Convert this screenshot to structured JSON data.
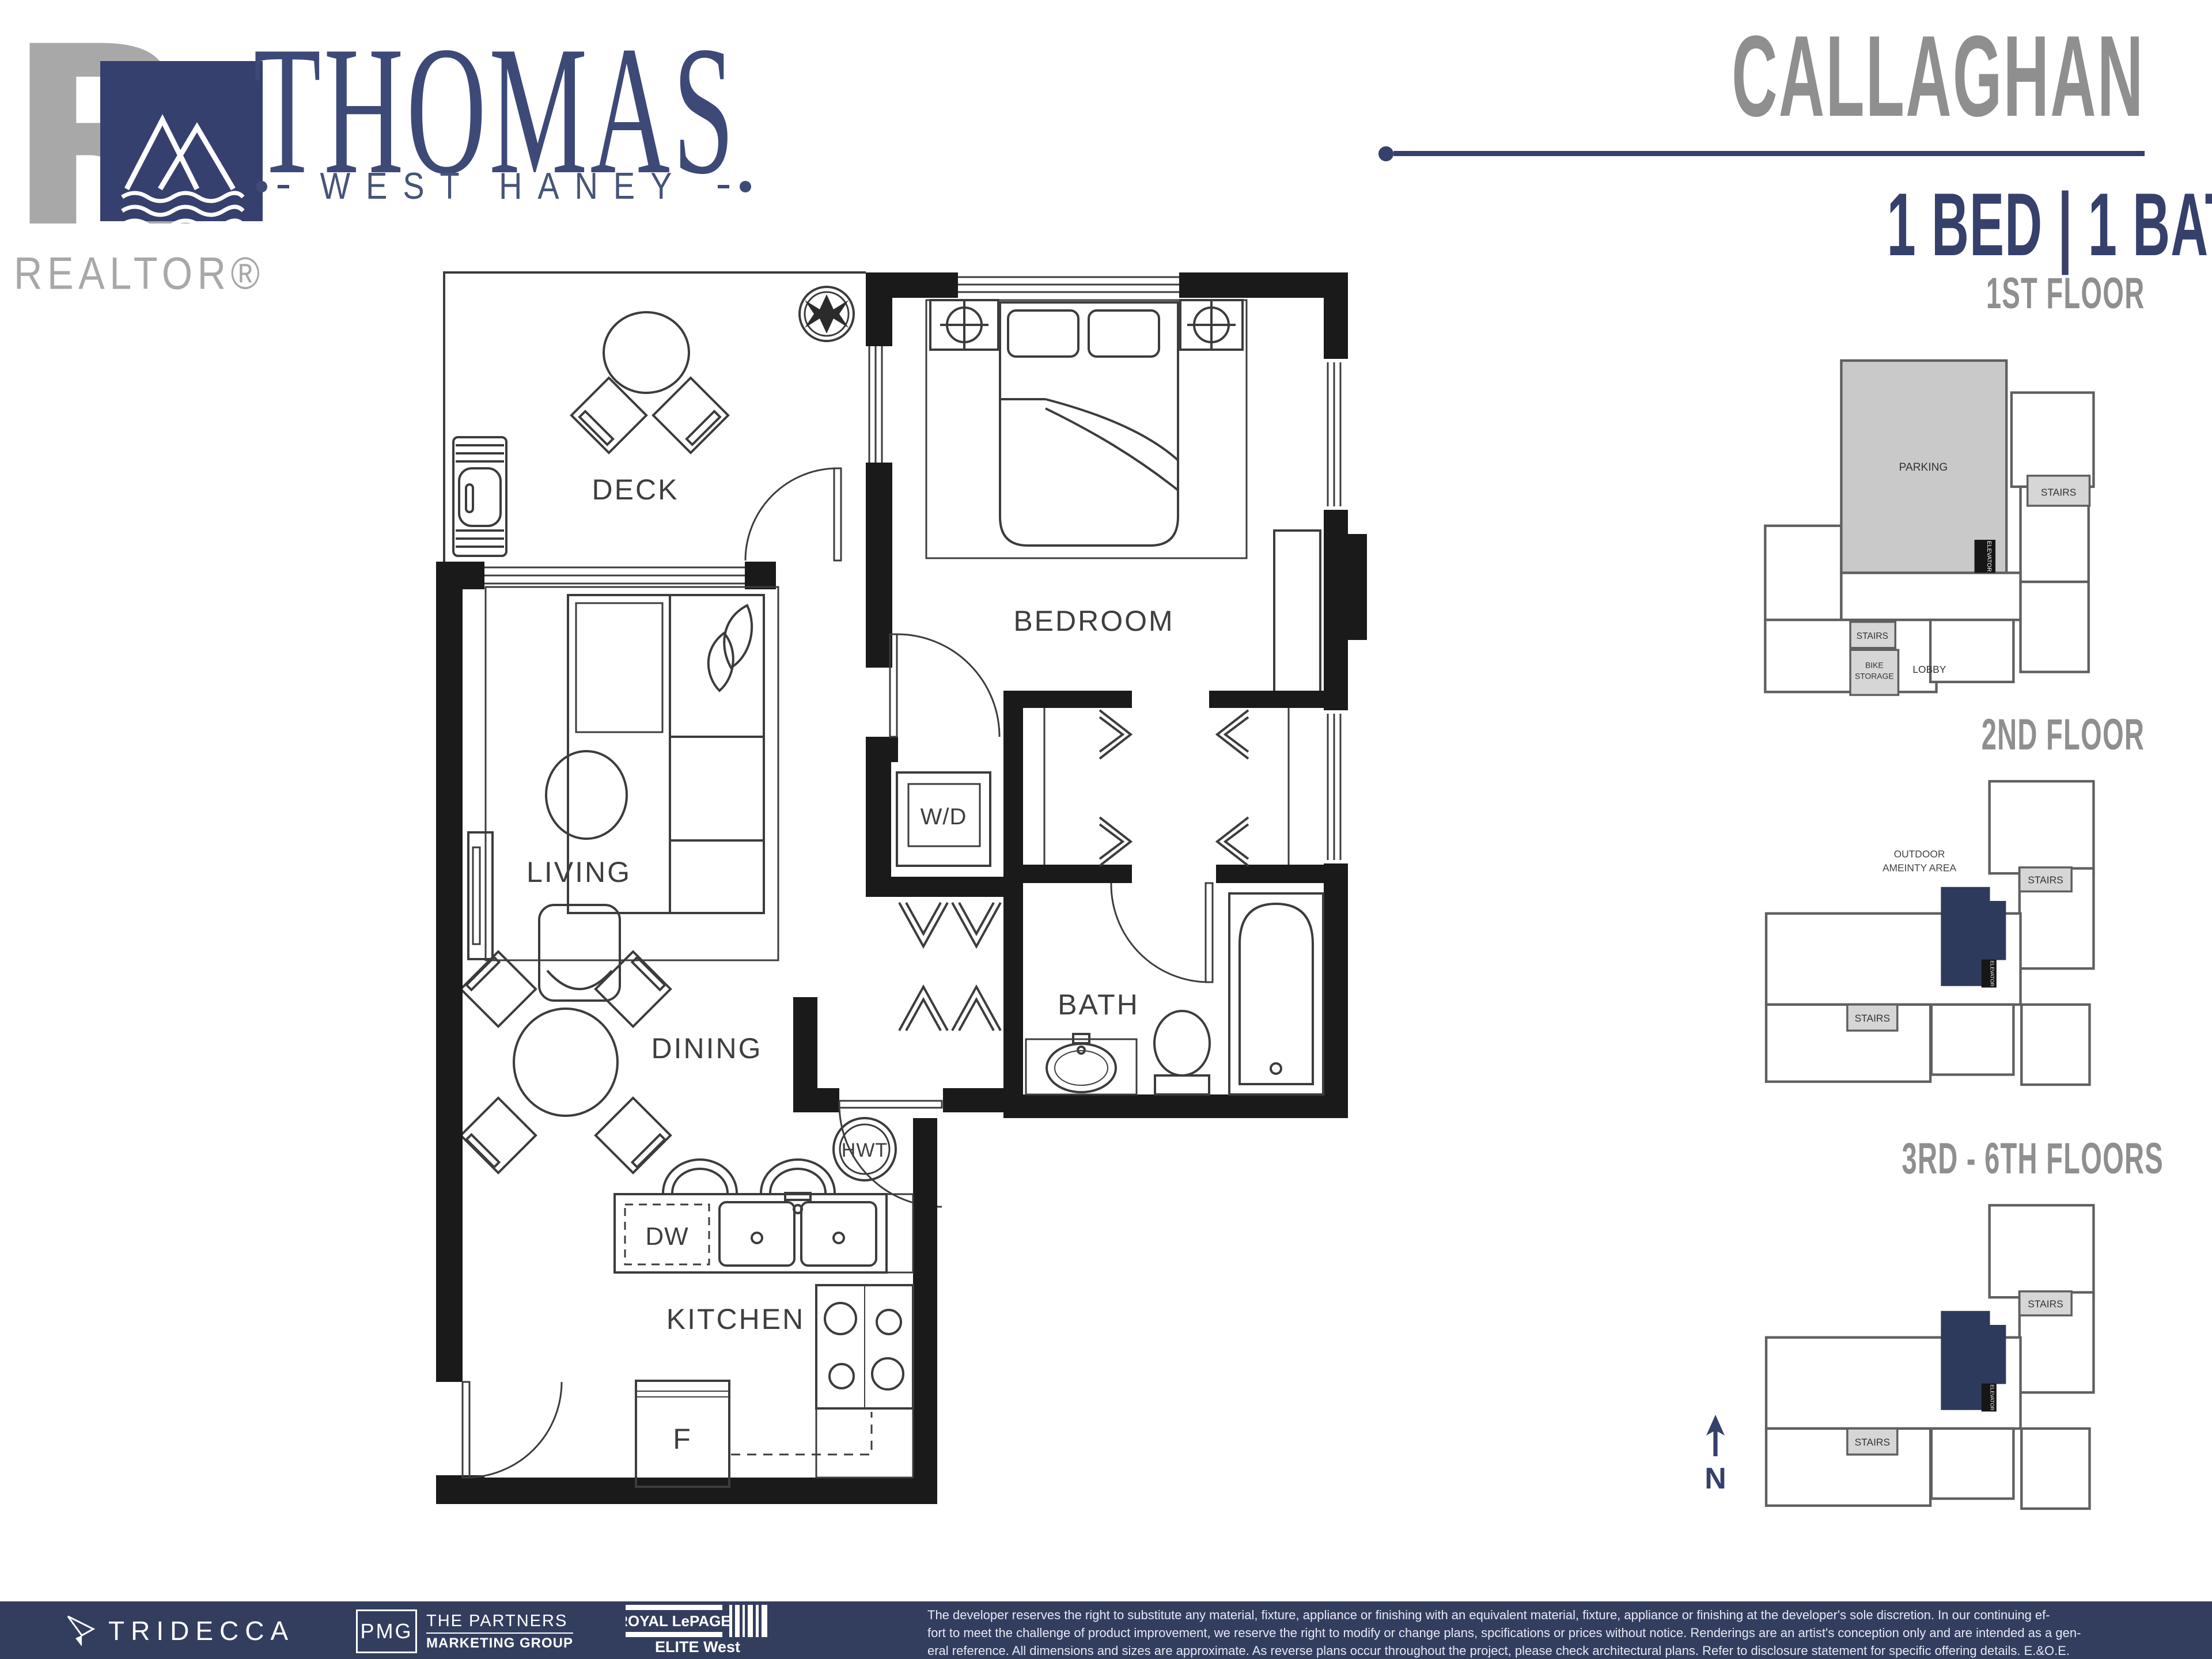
{
  "header": {
    "brand": {
      "realtor_label": "REALTOR®",
      "title": "THOMAS",
      "subtitle": "WEST HANEY"
    },
    "unit": {
      "name": "CALLAGHAN",
      "specs": "1 BED | 1 BATH | 618 SQ.FT."
    }
  },
  "floorplan": {
    "rooms": {
      "deck": "DECK",
      "bedroom": "BEDROOM",
      "living": "LIVING",
      "dining": "DINING",
      "bath": "BATH",
      "kitchen": "KITCHEN"
    },
    "fixtures": {
      "wd": "W/D",
      "hwt": "HWT",
      "dw": "DW",
      "fridge": "F"
    }
  },
  "keyplans": {
    "first": {
      "title": "1ST FLOOR",
      "parking": "PARKING",
      "stairs_upper": "STAIRS",
      "stairs_lower": "STAIRS",
      "bike_line1": "BIKE",
      "bike_line2": "STORAGE",
      "lobby": "LOBBY",
      "elevator": "ELEVATOR"
    },
    "second": {
      "title": "2ND FLOOR",
      "outdoor_line1": "OUTDOOR",
      "outdoor_line2": "AMEINTY AREA",
      "stairs_upper": "STAIRS",
      "stairs_lower": "STAIRS",
      "elevator": "ELEVATOR"
    },
    "upper": {
      "title": "3RD - 6TH FLOORS",
      "stairs_upper": "STAIRS",
      "stairs_lower": "STAIRS",
      "elevator": "ELEVATOR"
    },
    "north_label": "N"
  },
  "footer": {
    "logos": {
      "tridecca": "TRIDECCA",
      "pmg_abbr": "PMG",
      "pmg_line1": "THE PARTNERS",
      "pmg_line2": "MARKETING GROUP",
      "royal": "ROYAL LePAGE",
      "royal_sub": "ELITE West"
    },
    "disclaimer_lines": [
      "The developer reserves the right to substitute any material, fixture, appliance or finishing with an equivalent material, fixture, appliance or finishing at the developer's sole discretion. In our continuing ef-",
      "fort to meet the challenge of product improvement, we reserve the right to modify or change plans, spcifications or prices without notice. Renderings are an artist's conception only and are intended as a gen-",
      "eral reference. All dimensions and sizes are approximate. As reverse plans occur throughout the project, please check architectural plans. Refer to disclosure statement for specific offering details. E.&O.E."
    ]
  },
  "colors": {
    "navy": "#35406b",
    "footer_navy": "#333e5f",
    "title_gray": "#8f8f8f",
    "unit_highlight": "#2e3a5c",
    "parking_gray": "#c9c9c9",
    "stairs_gray": "#d6d6d6"
  }
}
